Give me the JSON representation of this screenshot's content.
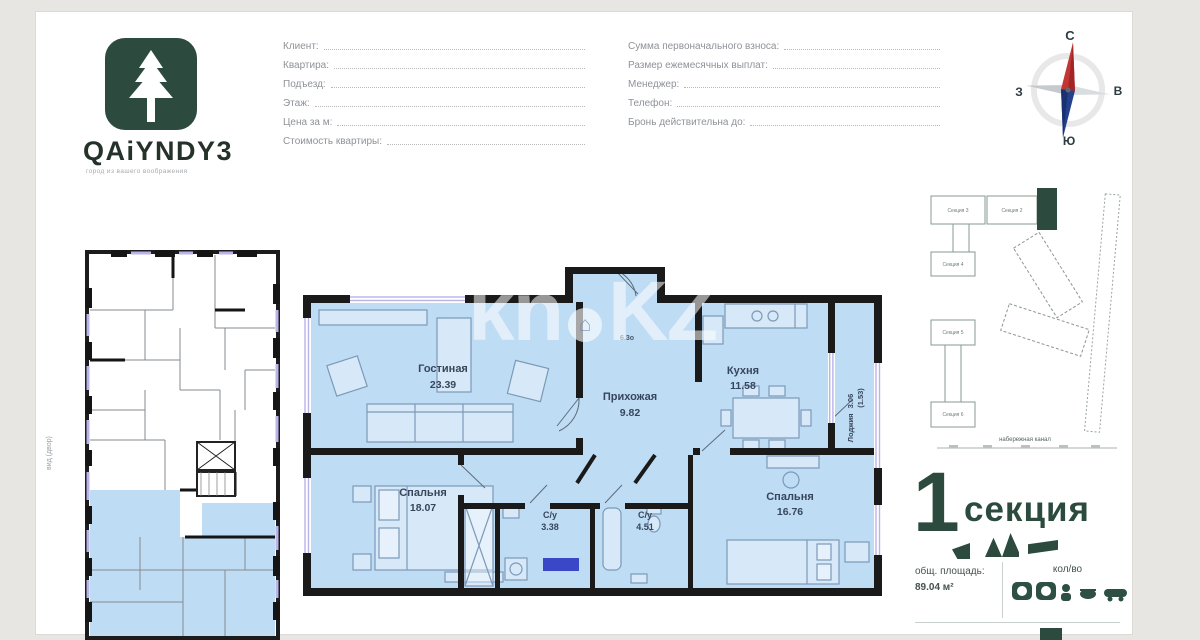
{
  "brand": {
    "name": "QAiYNDY3",
    "tagline": "город из вашего воображения"
  },
  "form": {
    "left_fields": [
      {
        "label": "Клиент:"
      },
      {
        "label": "Квартира:"
      },
      {
        "label": "Подъезд:"
      },
      {
        "label": "Этаж:"
      },
      {
        "label": "Цена за м:"
      },
      {
        "label": "Стоимость квартиры:"
      }
    ],
    "right_fields": [
      {
        "label": "Сумма первоначального взноса:"
      },
      {
        "label": "Размер ежемесячных выплат:"
      },
      {
        "label": "Менеджер:"
      },
      {
        "label": "Телефон:"
      },
      {
        "label": "Бронь действительна до:"
      }
    ]
  },
  "compass": {
    "north": "С",
    "east": "В",
    "west": "З",
    "south": "Ю"
  },
  "watermark": {
    "left": "kn",
    "right": "KZ",
    "icon": "house-circle-icon"
  },
  "side_note": "вид (двор)",
  "apartment": {
    "note": "6.3о",
    "rooms": {
      "living": {
        "name": "Гостиная",
        "area": "23.39"
      },
      "hall": {
        "name": "Прихожая",
        "area": "9.82"
      },
      "kitchen": {
        "name": "Кухня",
        "area": "11.58"
      },
      "loggia": {
        "name": "Лоджия",
        "area": "3.06",
        "area_reduced": "(1.53)"
      },
      "bedroom1": {
        "name": "Спальня",
        "area": "18.07"
      },
      "bath1": {
        "name": "С/у",
        "area": "3.38"
      },
      "bath2": {
        "name": "С/у",
        "area": "4.51"
      },
      "bedroom2": {
        "name": "Спальня",
        "area": "16.76"
      }
    }
  },
  "site_plan": {
    "sections": {
      "s2": "Секция 2",
      "s3": "Секция 3",
      "s4": "Секция 4",
      "s5": "Секция 5",
      "s6": "Секция 6"
    },
    "caption": "набережная канал"
  },
  "section_block": {
    "number": "1",
    "label": "секция",
    "info": {
      "area_label": "общ. площадь:",
      "area_value": "89.04 м²",
      "qty_label": "кол/во"
    }
  },
  "colors": {
    "brand_green": "#2d4a3e",
    "plan_fill": "#bedcf4",
    "wall": "#1a1a1a",
    "window": "#b8b4ea",
    "badge_blue": "#3a47c6",
    "needle_red": "#c33636",
    "needle_blue": "#24418f"
  }
}
